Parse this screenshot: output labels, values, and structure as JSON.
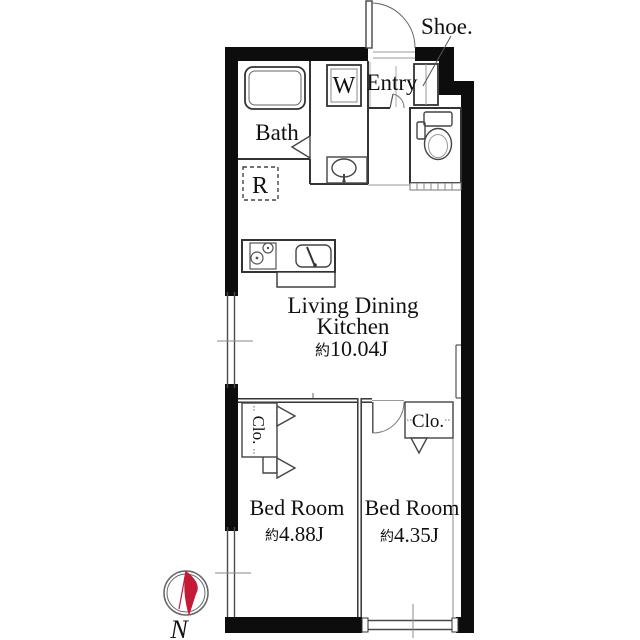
{
  "floorplan": {
    "background": "#ffffff",
    "wall_color": "#0d0d0d",
    "line_color": "#3a3a3a",
    "accent_color": "#c41a35",
    "rooms": {
      "entry": {
        "label": "Entry"
      },
      "shoe_cabinet": {
        "label": "Shoe."
      },
      "bath": {
        "label": "Bath"
      },
      "washing_machine": {
        "label": "W"
      },
      "refrigerator": {
        "label": "R"
      },
      "living_dining_kitchen": {
        "label_line1": "Living Dining",
        "label_line2": "Kitchen",
        "area_prefix": "約",
        "area": "10.04J"
      },
      "bedroom_left": {
        "label": "Bed Room",
        "area_prefix": "約",
        "area": "4.88J",
        "closet": "Clo."
      },
      "bedroom_right": {
        "label": "Bed Room",
        "area_prefix": "約",
        "area": "4.35J",
        "closet": "Clo."
      }
    },
    "compass": {
      "label": "N"
    }
  }
}
